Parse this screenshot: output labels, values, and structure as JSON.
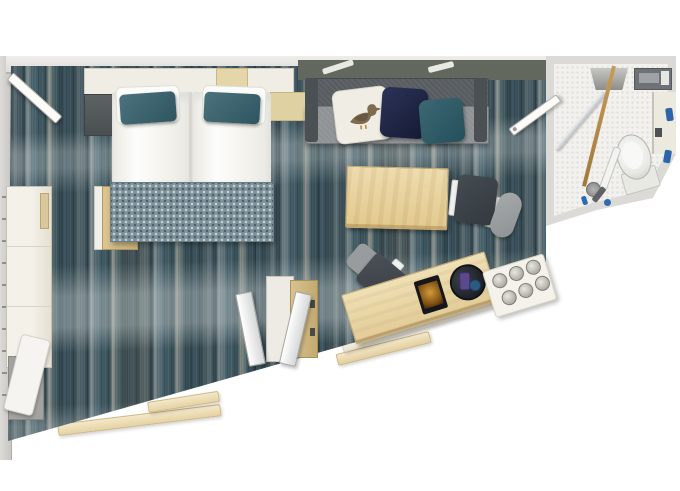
{
  "scene": {
    "kind": "floor-plan",
    "view": "top-down",
    "description": "cabin floor plan with bedroom, living area and bathroom on a dark teal striated floor"
  },
  "colors": {
    "floor_dark": "#2e424b",
    "floor_mid": "#46606a",
    "floor_light": "#8e948e",
    "wall": "#dddcd8",
    "wood": "#e8d4a4",
    "beige_sill": "#e6d3a4",
    "cream": "#efede4",
    "sofa_back": "#575c60",
    "sofa_seat": "#8e9294",
    "pillow_teal": "#3a626d",
    "pillow_navy": "#1c2340",
    "runner_blanket": "#7d929a",
    "chair_dark": "#3f464c",
    "chair_gray": "#9aa0a2",
    "bathroom_floor": "#f2f1ed",
    "toiletry_blue": "#2d66a8",
    "outside": "#ffffff"
  },
  "items": {
    "floor": "cabin floor",
    "left_wall": "left wall",
    "top_wall": "top wall",
    "entrance_door": "entrance door, open",
    "headboard": "headboard console",
    "headboard_accent": "headboard shelf unit",
    "nightstand_left": "left nightstand",
    "nightstand_right": "right nightstand",
    "bed": "double bed",
    "pillow": "pillow",
    "accent_pillow": "teal accent pillow",
    "bed_runner": "patterned bed runner",
    "wardrobe_left": "wardrobe counter",
    "closet_door": "open closet door",
    "bench": "luggage bench",
    "sofa": "sofa",
    "cushion_seagull": "seagull print cushion",
    "cushion_navy": "navy cushion",
    "cushion_teal": "teal cushion",
    "coffee_table": "coffee table",
    "chair_lounge": "lounge chair",
    "chair_desk": "desk chair",
    "open_wardrobe": "wardrobe with open doors",
    "wardrobe_door": "wardrobe door",
    "desk": "desk sideboard",
    "tablet": "tablet menu",
    "minibar_tray": "minibar tray with bottles",
    "glasses_tray": "tray with glasses",
    "glass": "drinking glass",
    "window_sill": "window sill",
    "bathroom": "bathroom",
    "bathroom_floor": "bathroom tiled floor",
    "shower_glass": "shower glass partition",
    "washbasin": "washbasin",
    "bathroom_cabinet": "bathroom cabinet",
    "bathroom_counter": "bathroom counter",
    "towel_pipe": "towel rail",
    "toilet": "toilet",
    "grab_bar": "grab bar",
    "shower": "hand shower and drain",
    "toiletry": "toiletry bottle",
    "bathroom_door": "bathroom door, open"
  }
}
